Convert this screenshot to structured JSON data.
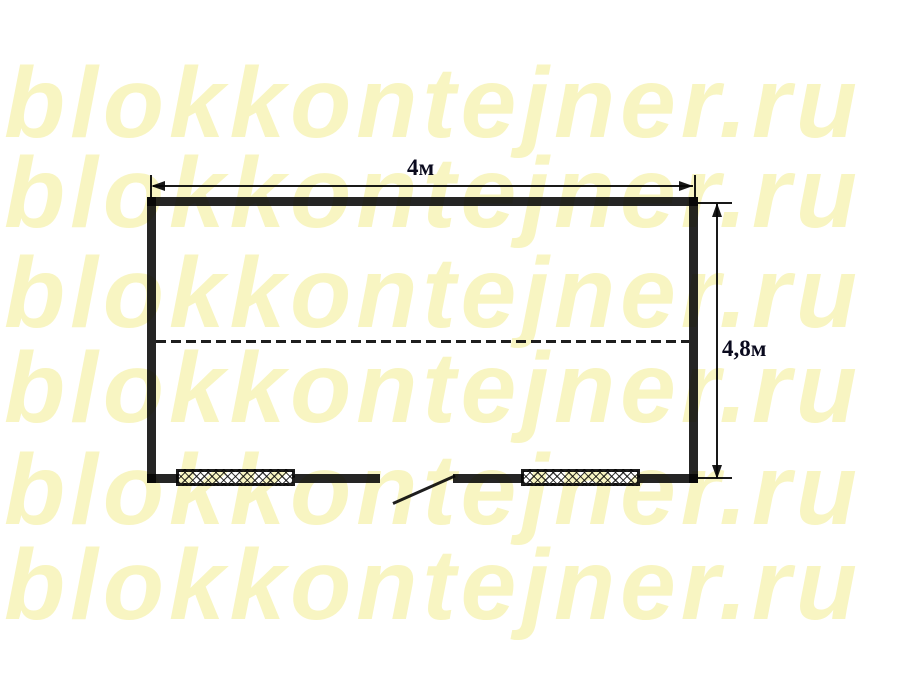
{
  "diagram": {
    "type": "block-container floor plan",
    "width_dimension_label": "4м",
    "height_dimension_label": "4,8м"
  },
  "watermark": {
    "text": "blokkontejner.ru",
    "row_count": 6,
    "color": "#F8F5C2"
  },
  "colors": {
    "background": "#FFFFFF",
    "line": "#000000",
    "label_text": "#0A0A1E"
  }
}
